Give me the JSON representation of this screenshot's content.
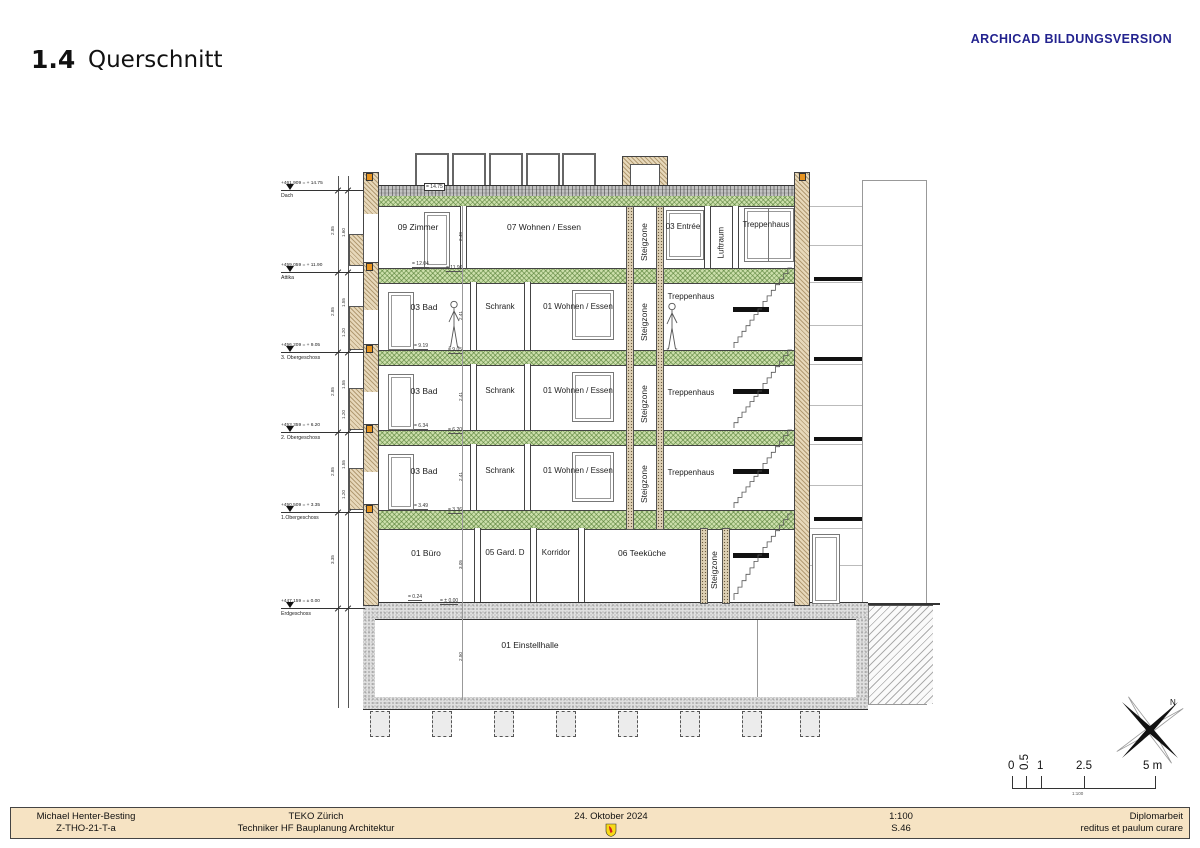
{
  "sheet": {
    "number": "1.4",
    "title": "Querschnitt"
  },
  "watermark": {
    "text": "ARCHICAD BILDUNGSVERSION",
    "color": "#23238f"
  },
  "levels": [
    {
      "elevation": "+461.909 = + 14.75",
      "name": "Dach"
    },
    {
      "elevation": "+459.059 = + 11.90",
      "name": "Attika"
    },
    {
      "elevation": "+456.209 = + 9.05",
      "name": "3. Obergeschoss"
    },
    {
      "elevation": "+453.359 = + 6.20",
      "name": "2. Obergeschoss"
    },
    {
      "elevation": "+450.509 = + 3.35",
      "name": "1.Obergeschoss"
    },
    {
      "elevation": "+447.159 = ± 0.00",
      "name": "Erdgeschoss"
    }
  ],
  "rooms": {
    "attic": [
      "09 Zimmer",
      "07 Wohnen / Essen",
      "Steigzone",
      "03 Entrée",
      "Luftraum",
      "Treppenhaus"
    ],
    "og": [
      "03 Bad",
      "Schrank",
      "01 Wohnen / Essen",
      "Steigzone",
      "Treppenhaus"
    ],
    "eg": [
      "01 Büro",
      "05 Gard. D",
      "Korridor",
      "06 Teeküche",
      "Steigzone"
    ],
    "ug": [
      "01 Einstellhalle"
    ]
  },
  "marks": {
    "roof": "= 14.75",
    "attika_a": "= 12.04",
    "attika_b": "= 11.90",
    "og3_a": "= 9.19",
    "og3_b": "= 9.05",
    "og2_a": "= 6.34",
    "og2_b": "= 6.20",
    "og1_a": "= 3.49",
    "og1_b": "= 3.36",
    "eg_a": "= 0.24",
    "eg_b": "= ± 0.00"
  },
  "dims": {
    "floor": "2.85",
    "eg_floor": "3.35",
    "attic_h": "2.48",
    "room_h": "2.41",
    "eg_h": "3.05",
    "ug_h": "2.50",
    "w_top": "1.55",
    "w_bot": "1.20",
    "parapet": "1.60"
  },
  "scalebar": {
    "t0": "0",
    "t05": "0.5",
    "t1": "1",
    "t25": "2.5",
    "t5": "5 m",
    "scale": "1:100"
  },
  "compass": {
    "north": "N"
  },
  "footer": {
    "author": "Michael Henter-Besting",
    "doc_code": "Z-THO-21-T-a",
    "school": "TEKO Zürich",
    "program": "Techniker HF Bauplanung Architektur",
    "date": "24. Oktober 2024",
    "scale": "1:100",
    "page": "S.46",
    "work": "Diplomarbeit",
    "motto": "reditus et paulum curare"
  }
}
